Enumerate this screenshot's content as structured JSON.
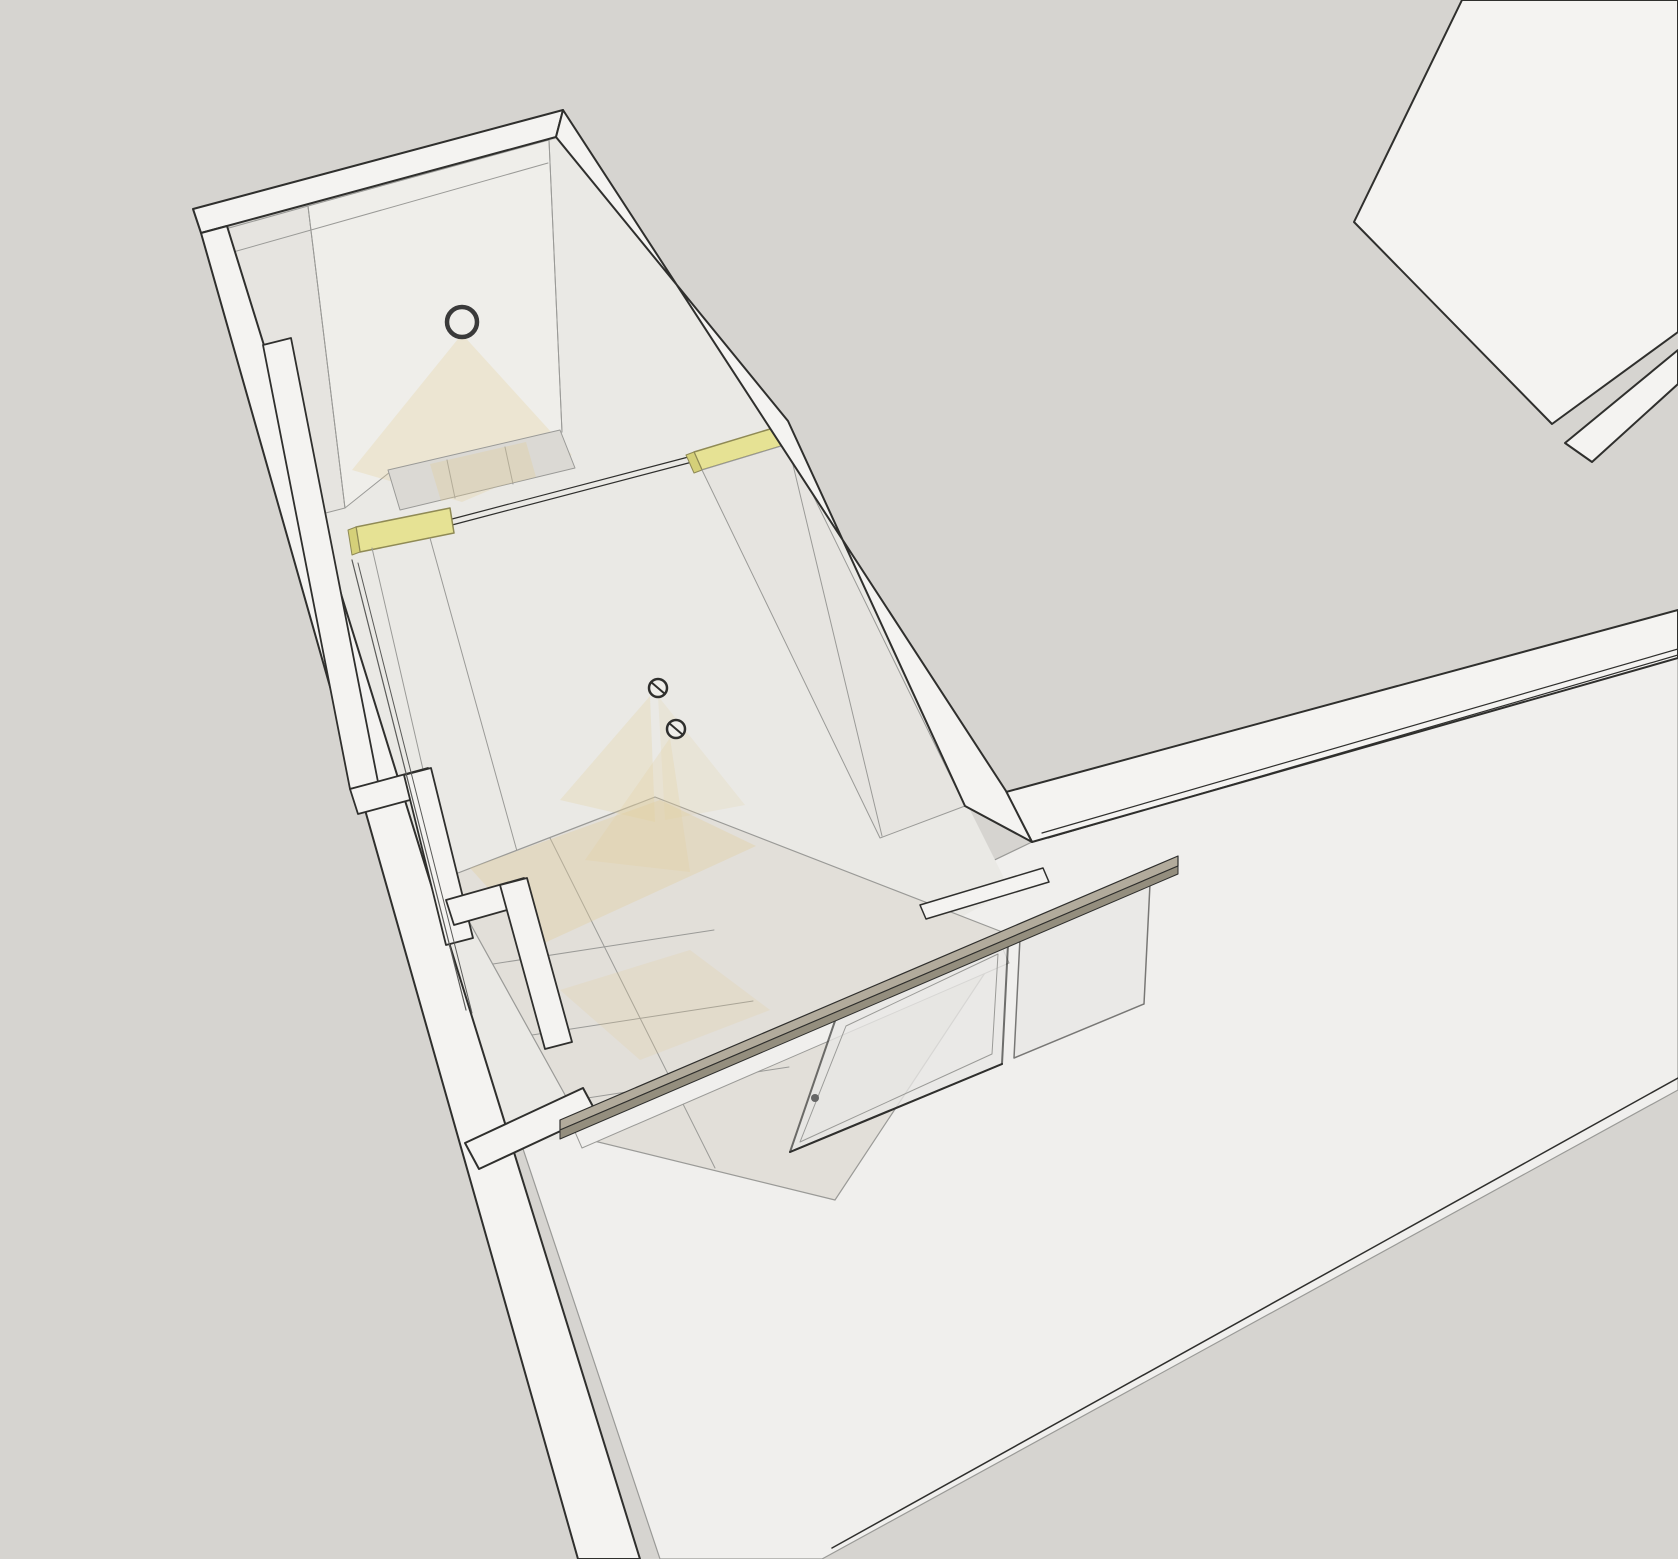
{
  "colors": {
    "bg": "#d6d4d0",
    "white1": "#f4f3f1",
    "white2": "#f0efed",
    "white3": "#efeeea",
    "int1": "#eae9e5",
    "int2": "#e6e4e0",
    "tile1": "#dbd9d4",
    "tile2": "#e2dfd9",
    "yellow": "#e6e294",
    "yellowEdge": "#8f8a55",
    "yellowDark": "#d5d079",
    "rail": "#b2ab9c",
    "railDark": "#948e7e",
    "glass": "#e9e8e6",
    "glassEdge": "#4a4a48",
    "line": "#2f2f2d",
    "gray": "#9a9a97",
    "sliver": "#5a5a58",
    "glow": "#e3cf9c",
    "ring": "#3a3a3a",
    "handle": "#666666"
  },
  "shapes": [
    {
      "name": "background",
      "type": "rect",
      "x": 0,
      "y": 0,
      "w": 1678,
      "h": 1559,
      "fill": "bg"
    },
    {
      "name": "roof-block-top-right",
      "type": "polygon",
      "points": "1462,0 1678,0 1678,332 1552,424 1354,222",
      "fill": "white1",
      "stroke": "line",
      "sw": 2
    },
    {
      "name": "wall-strip-top-right",
      "type": "polygon",
      "points": "1565,443 1678,350 1678,384 1592,462",
      "fill": "white1",
      "stroke": "line",
      "sw": 2
    },
    {
      "name": "big-room-floor",
      "type": "polygon",
      "points": "1032,842 1678,658 1678,1090 822,1559 660,1559 505,1095",
      "fill": "white2",
      "stroke": "gray",
      "sw": 1.2
    },
    {
      "name": "big-room-floor-edge",
      "type": "line",
      "x1": 1678,
      "y1": 1078,
      "x2": 832,
      "y2": 1548,
      "stroke": "line",
      "sw": 1.5
    },
    {
      "name": "right-wall-top-band",
      "type": "polygon",
      "points": "1006,792 1678,610 1678,658 1032,842",
      "fill": "white1",
      "stroke": "line",
      "sw": 2
    },
    {
      "name": "right-wall-track-1",
      "type": "line",
      "x1": 1042,
      "y1": 833,
      "x2": 1678,
      "y2": 649,
      "stroke": "line",
      "sw": 1.2
    },
    {
      "name": "right-wall-track-2",
      "type": "line",
      "x1": 1048,
      "y1": 838,
      "x2": 1678,
      "y2": 655,
      "stroke": "line",
      "sw": 1.2
    },
    {
      "name": "corridor-interior",
      "type": "polygon",
      "points": "204,235 556,139 788,421 970,810 1010,890 560,1140 470,1140 314,516",
      "fill": "int1"
    },
    {
      "name": "corridor-left-wall-upper",
      "type": "polygon",
      "points": "204,235 308,206 345,508 314,516",
      "fill": "int2",
      "stroke": "gray",
      "sw": 1
    },
    {
      "name": "corridor-far-wall",
      "type": "polygon",
      "points": "308,206 549,140 562,432 390,472 345,508",
      "fill": "white3",
      "stroke": "gray",
      "sw": 1
    },
    {
      "name": "far-wall-seam",
      "type": "line",
      "x1": 308,
      "y1": 206,
      "x2": 345,
      "y2": 508,
      "stroke": "gray",
      "sw": 1
    },
    {
      "name": "far-wall-corner-seam",
      "type": "line",
      "x1": 549,
      "y1": 140,
      "x2": 562,
      "y2": 432,
      "stroke": "gray",
      "sw": 1
    },
    {
      "name": "ceiling-lamp-glow",
      "type": "polygon",
      "points": "462,334 352,470 462,502 572,455",
      "fill": "glow",
      "op": 0.3
    },
    {
      "name": "ceiling-lamp-ring",
      "type": "circle",
      "cx": 462,
      "cy": 322,
      "r": 15,
      "fill": "none",
      "stroke": "ring",
      "sw": 4.5
    },
    {
      "name": "upper-room-floor",
      "type": "polygon",
      "points": "388,470 560,430 575,468 400,510",
      "fill": "tile1",
      "stroke": "gray",
      "sw": 1
    },
    {
      "name": "upper-floor-seam-1",
      "type": "line",
      "x1": 447,
      "y1": 460,
      "x2": 455,
      "y2": 498,
      "stroke": "gray",
      "sw": 1
    },
    {
      "name": "upper-floor-seam-2",
      "type": "line",
      "x1": 505,
      "y1": 447,
      "x2": 513,
      "y2": 484,
      "stroke": "gray",
      "sw": 1
    },
    {
      "name": "upper-floor-warm-glow",
      "type": "polygon",
      "points": "430,464 526,442 536,477 441,501",
      "fill": "glow",
      "op": 0.35
    },
    {
      "name": "partition-track-1",
      "type": "line",
      "x1": 452,
      "y1": 519,
      "x2": 696,
      "y2": 455,
      "stroke": "line",
      "sw": 1.2
    },
    {
      "name": "partition-track-2",
      "type": "line",
      "x1": 452,
      "y1": 525,
      "x2": 696,
      "y2": 461,
      "stroke": "line",
      "sw": 1.2
    },
    {
      "name": "transom-window-left",
      "type": "polygon",
      "points": "356,527 450,508 454,533 360,552",
      "fill": "yellow",
      "stroke": "yellowEdge",
      "sw": 1.5
    },
    {
      "name": "transom-window-left-end",
      "type": "polygon",
      "points": "348,530 356,527 360,552 352,555",
      "fill": "yellowDark",
      "stroke": "yellowEdge",
      "sw": 1
    },
    {
      "name": "transom-window-right",
      "type": "polygon",
      "points": "694,452 780,426 788,444 702,470",
      "fill": "yellow",
      "stroke": "yellowEdge",
      "sw": 1.5
    },
    {
      "name": "transom-window-right-end",
      "type": "polygon",
      "points": "686,455 694,452 702,470 694,473",
      "fill": "yellowDark",
      "stroke": "yellowEdge",
      "sw": 1
    },
    {
      "name": "corridor-right-wall-face",
      "type": "polygon",
      "points": "702,470 788,444 965,806 880,838",
      "fill": "int2",
      "stroke": "gray",
      "sw": 1
    },
    {
      "name": "right-wall-face-seam",
      "type": "line",
      "x1": 788,
      "y1": 444,
      "x2": 882,
      "y2": 836,
      "stroke": "gray",
      "sw": 1
    },
    {
      "name": "left-wall-seam-1",
      "type": "line",
      "x1": 372,
      "y1": 548,
      "x2": 448,
      "y2": 878,
      "stroke": "gray",
      "sw": 1
    },
    {
      "name": "left-wall-seam-2",
      "type": "line",
      "x1": 430,
      "y1": 538,
      "x2": 520,
      "y2": 862,
      "stroke": "gray",
      "sw": 1
    },
    {
      "name": "shower-floor-tiles",
      "type": "polygon",
      "points": "445,878 655,797 1010,935 835,1200 590,1140",
      "fill": "tile2",
      "stroke": "gray",
      "sw": 1.2
    },
    {
      "name": "tile-seam-axis",
      "type": "line",
      "x1": 550,
      "y1": 838,
      "x2": 715,
      "y2": 1168,
      "stroke": "gray",
      "sw": 1
    },
    {
      "name": "tile-seam-cross-1",
      "type": "line",
      "x1": 493,
      "y1": 964,
      "x2": 714,
      "y2": 930,
      "stroke": "gray",
      "sw": 1
    },
    {
      "name": "tile-seam-cross-2",
      "type": "line",
      "x1": 532,
      "y1": 1035,
      "x2": 753,
      "y2": 1001,
      "stroke": "gray",
      "sw": 1
    },
    {
      "name": "tile-seam-cross-3",
      "type": "line",
      "x1": 568,
      "y1": 1101,
      "x2": 789,
      "y2": 1067,
      "stroke": "gray",
      "sw": 1
    },
    {
      "name": "tiles-warm-glow-1",
      "type": "polygon",
      "points": "470,868 660,800 756,846 540,945",
      "fill": "glow",
      "op": 0.35
    },
    {
      "name": "tiles-warm-glow-2",
      "type": "polygon",
      "points": "560,990 690,950 770,1010 640,1060",
      "fill": "glow",
      "op": 0.22
    },
    {
      "name": "spotlight-glow-1",
      "type": "polygon",
      "points": "650,696 560,800 655,822",
      "fill": "glow",
      "op": 0.28
    },
    {
      "name": "spotlight-glow-1b",
      "type": "polygon",
      "points": "658,696 745,805 665,820",
      "fill": "glow",
      "op": 0.18
    },
    {
      "name": "spotlight-glow-2",
      "type": "polygon",
      "points": "670,738 585,860 690,872",
      "fill": "glow",
      "op": 0.25
    },
    {
      "name": "wall-spotlight-1",
      "type": "circle",
      "cx": 658,
      "cy": 688,
      "r": 9,
      "fill": "white3",
      "stroke": "line",
      "sw": 2.5
    },
    {
      "name": "wall-spotlight-1-slash",
      "type": "line",
      "x1": 651,
      "y1": 682,
      "x2": 665,
      "y2": 694,
      "stroke": "line",
      "sw": 2
    },
    {
      "name": "wall-spotlight-2",
      "type": "circle",
      "cx": 676,
      "cy": 729,
      "r": 9,
      "fill": "white3",
      "stroke": "line",
      "sw": 2.5
    },
    {
      "name": "wall-spotlight-2-slash",
      "type": "line",
      "x1": 669,
      "y1": 723,
      "x2": 683,
      "y2": 735,
      "stroke": "line",
      "sw": 2
    },
    {
      "name": "outer-wall-band-northwest",
      "type": "polygon",
      "points": "193,209 563,110 556,137 201,233",
      "fill": "white1",
      "stroke": "line",
      "sw": 2
    },
    {
      "name": "northwest-band-inner-line",
      "type": "line",
      "x1": 212,
      "y1": 258,
      "x2": 548,
      "y2": 163,
      "stroke": "gray",
      "sw": 1
    },
    {
      "name": "outer-wall-band-northeast",
      "type": "polygon",
      "points": "563,110 1006,791 1032,842 965,806 788,421 556,137",
      "fill": "white1",
      "stroke": "line",
      "sw": 2
    },
    {
      "name": "outer-wall-band-southwest",
      "type": "polygon",
      "points": "201,233 227,226 640,1559 578,1559",
      "fill": "white1",
      "stroke": "line",
      "sw": 2
    },
    {
      "name": "parapet-step-1",
      "type": "polygon",
      "points": "263,345 291,338 378,782 350,789",
      "fill": "white1",
      "stroke": "line",
      "sw": 1.8
    },
    {
      "name": "parapet-step-2",
      "type": "polygon",
      "points": "350,789 428,768 436,793 358,814",
      "fill": "white1",
      "stroke": "line",
      "sw": 1.8
    },
    {
      "name": "parapet-step-3",
      "type": "polygon",
      "points": "404,775 431,768 473,938 446,945",
      "fill": "white1",
      "stroke": "line",
      "sw": 1.8
    },
    {
      "name": "parapet-step-4",
      "type": "polygon",
      "points": "446,900 524,878 532,903 454,925",
      "fill": "white1",
      "stroke": "line",
      "sw": 1.8
    },
    {
      "name": "parapet-step-5",
      "type": "polygon",
      "points": "500,885 527,878 572,1042 545,1049",
      "fill": "white1",
      "stroke": "line",
      "sw": 1.8
    },
    {
      "name": "wall-gap-sliver-1",
      "type": "line",
      "x1": 352,
      "y1": 560,
      "x2": 466,
      "y2": 1010,
      "stroke": "sliver",
      "sw": 1.2
    },
    {
      "name": "wall-gap-sliver-2",
      "type": "line",
      "x1": 358,
      "y1": 563,
      "x2": 472,
      "y2": 1013,
      "stroke": "sliver",
      "sw": 1
    },
    {
      "name": "bottom-left-wall-segment",
      "type": "polygon",
      "points": "465,1143 583,1088 597,1114 479,1169",
      "fill": "white1",
      "stroke": "line",
      "sw": 2
    },
    {
      "name": "door-post-top",
      "type": "polygon",
      "points": "920,905 1043,868 1049,882 926,919",
      "fill": "white1",
      "stroke": "line",
      "sw": 1.5
    },
    {
      "name": "shower-threshold",
      "type": "polygon",
      "points": "575,1132 1002,947 1009,963 582,1148",
      "fill": "white2",
      "stroke": "gray",
      "sw": 1
    },
    {
      "name": "glass-panel-fixed",
      "type": "polygon",
      "points": "1020,938 1150,884 1144,1004 1014,1058",
      "fill": "glass",
      "op": 0.72,
      "stroke": "glassEdge",
      "sw": 1.5
    },
    {
      "name": "glass-shower-door",
      "type": "polygon",
      "points": "836,1018 1008,944 1002,1064 790,1152",
      "fill": "glass",
      "op": 0.78,
      "stroke": "glassEdge",
      "sw": 2
    },
    {
      "name": "glass-door-inner-frame",
      "type": "polygon",
      "points": "846,1026 998,954 992,1054 800,1142",
      "fill": "none",
      "stroke": "gray",
      "sw": 1
    },
    {
      "name": "glass-door-bottom-edge",
      "type": "line",
      "x1": 790,
      "y1": 1152,
      "x2": 1002,
      "y2": 1064,
      "stroke": "line",
      "sw": 2
    },
    {
      "name": "door-handle",
      "type": "circle",
      "cx": 815,
      "cy": 1098,
      "r": 4,
      "fill": "handle"
    },
    {
      "name": "shower-rail-top",
      "type": "polygon",
      "points": "560,1120 1178,856 1178,866 560,1130",
      "fill": "rail",
      "stroke": "line",
      "sw": 1.2
    },
    {
      "name": "shower-rail-side",
      "type": "polygon",
      "points": "560,1130 1178,866 1178,874 560,1139",
      "fill": "railDark",
      "stroke": "line",
      "sw": 1
    }
  ]
}
